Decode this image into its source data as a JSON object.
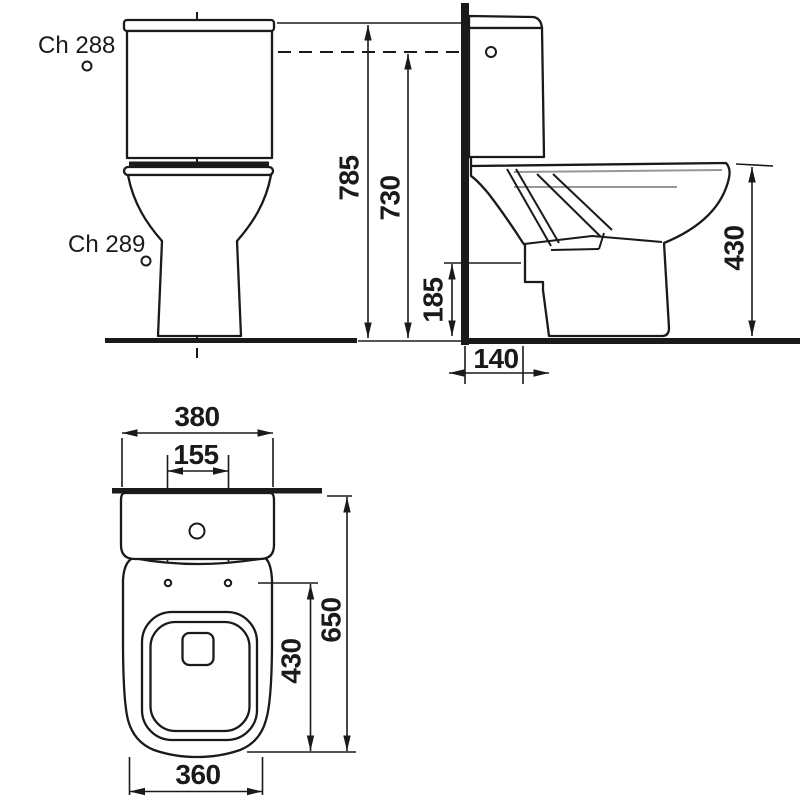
{
  "colors": {
    "line": "#1a1a1a",
    "gray_line": "#979797",
    "background": "#ffffff"
  },
  "labels": {
    "model_upper": "Ch 288",
    "model_lower": "Ch 289"
  },
  "dimensions": {
    "front": {
      "total_height": "785",
      "button_height": "730"
    },
    "side": {
      "outlet_height": "185",
      "rim_height": "430",
      "wall_offset": "140"
    },
    "plan": {
      "tank_width": "380",
      "hole_spacing": "155",
      "total_depth": "650",
      "bowl_depth": "430",
      "base_width": "360"
    }
  }
}
